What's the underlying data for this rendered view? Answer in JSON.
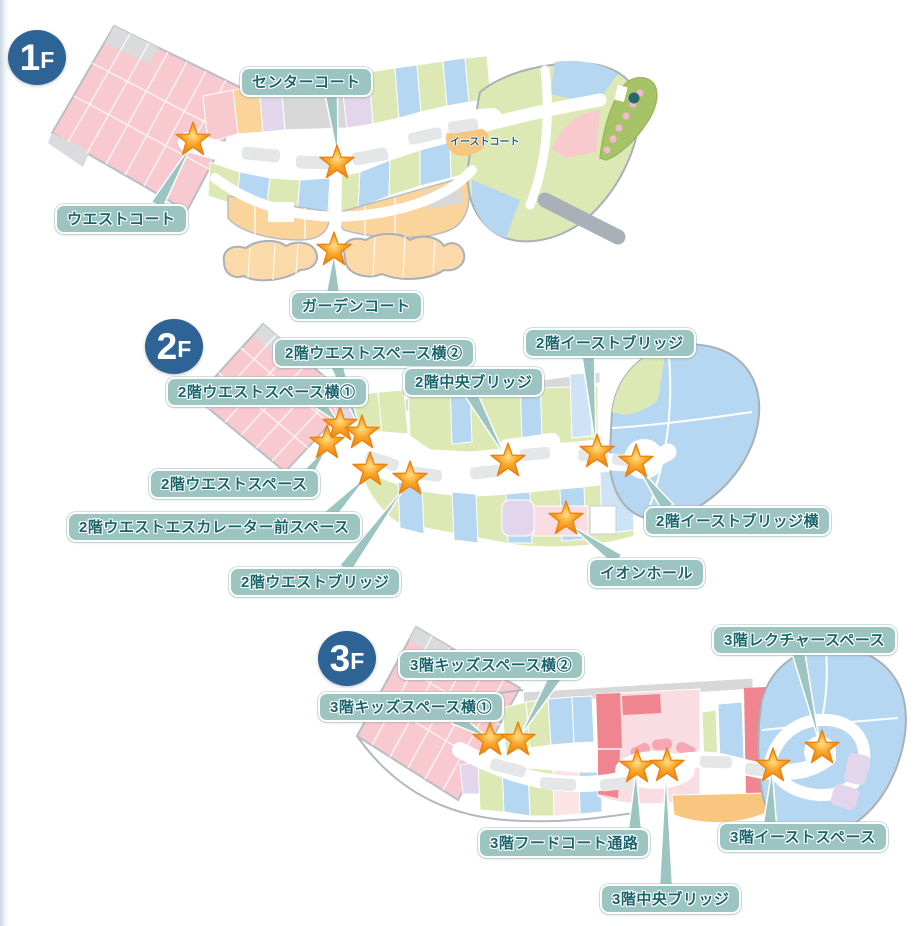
{
  "colors": {
    "badge_bg": "#2e6396",
    "badge_text": "#ffffff",
    "callout_bg": "#9cc5c1",
    "callout_text": "#19646c",
    "star_center": "#ffdf86",
    "star_mid": "#f9a62a",
    "star_outer": "#ef8008",
    "star_edge": "#e9820f",
    "map_pink": "#f8c9cf",
    "map_green": "#dce9b5",
    "map_blue": "#b5d7f2",
    "map_orange": "#fbd49c",
    "map_lavender": "#e2d5ec",
    "map_gray": "#d8d8d8",
    "map_food_pink": "#fadde2",
    "map_red": "#f0848f"
  },
  "floors": [
    {
      "id": "1f",
      "badge": {
        "number": "1",
        "suffix": "F",
        "cx": 37,
        "cy": 57
      },
      "stars": [
        [
          193,
          140
        ],
        [
          337,
          163
        ],
        [
          334,
          250
        ]
      ],
      "callouts": [
        {
          "text": "センターコート",
          "left": 240,
          "top": 67,
          "tail": {
            "from": [
              331,
              92
            ],
            "to": [
              338,
              158
            ]
          }
        },
        {
          "text": "ウエストコート",
          "left": 55,
          "top": 204,
          "tail": {
            "from": [
              157,
              205
            ],
            "to": [
              192,
              144
            ]
          }
        },
        {
          "text": "ガーデンコート",
          "left": 290,
          "top": 291,
          "tail": {
            "from": [
              333,
              292
            ],
            "to": [
              334,
              253
            ]
          }
        }
      ],
      "map_texts": [
        {
          "text": "イーストコート",
          "left": 450,
          "top": 133
        }
      ]
    },
    {
      "id": "2f",
      "badge": {
        "number": "2",
        "suffix": "F",
        "cx": 174,
        "cy": 346
      },
      "stars": [
        [
          340,
          425
        ],
        [
          362,
          433
        ],
        [
          327,
          443
        ],
        [
          370,
          470
        ],
        [
          410,
          479
        ],
        [
          508,
          461
        ],
        [
          597,
          452
        ],
        [
          636,
          462
        ],
        [
          566,
          519
        ]
      ],
      "callouts": [
        {
          "text": "2階ウエストスペース横②",
          "left": 273,
          "top": 338,
          "tail": {
            "from": [
              336,
              363
            ],
            "to": [
              360,
              430
            ]
          }
        },
        {
          "text": "2階ウエストスペース横①",
          "left": 166,
          "top": 377,
          "tail": {
            "from": [
              318,
              402
            ],
            "to": [
              339,
              423
            ]
          }
        },
        {
          "text": "2階中央ブリッジ",
          "left": 403,
          "top": 367,
          "tail": {
            "from": [
              470,
              392
            ],
            "to": [
              506,
              458
            ]
          }
        },
        {
          "text": "2階イーストブリッジ",
          "left": 524,
          "top": 328,
          "tail": {
            "from": [
              588,
              353
            ],
            "to": [
              596,
              449
            ]
          }
        },
        {
          "text": "2階ウエストスペース",
          "left": 149,
          "top": 469,
          "tail": {
            "from": [
              304,
              479
            ],
            "to": [
              328,
              446
            ]
          }
        },
        {
          "text": "2階ウエストエスカレーター前スペース",
          "left": 67,
          "top": 512,
          "tail": {
            "from": [
              328,
              517
            ],
            "to": [
              369,
              474
            ]
          }
        },
        {
          "text": "2階ウエストブリッジ",
          "left": 229,
          "top": 567,
          "tail": {
            "from": [
              345,
              569
            ],
            "to": [
              408,
              483
            ]
          }
        },
        {
          "text": "2階イーストブリッジ横",
          "left": 644,
          "top": 506,
          "tail": {
            "from": [
              668,
              508
            ],
            "to": [
              637,
              466
            ]
          }
        },
        {
          "text": "イオンホール",
          "left": 588,
          "top": 558,
          "tail": {
            "from": [
              618,
              560
            ],
            "to": [
              567,
              523
            ]
          }
        }
      ],
      "map_texts": []
    },
    {
      "id": "3f",
      "badge": {
        "number": "3",
        "suffix": "F",
        "cx": 347,
        "cy": 658
      },
      "stars": [
        [
          490,
          740
        ],
        [
          518,
          740
        ],
        [
          637,
          767
        ],
        [
          667,
          766
        ],
        [
          773,
          766
        ],
        [
          822,
          748
        ]
      ],
      "callouts": [
        {
          "text": "3階キッズスペース横②",
          "left": 398,
          "top": 650,
          "tail": {
            "from": [
              556,
              676
            ],
            "to": [
              519,
              738
            ]
          }
        },
        {
          "text": "3階キッズスペース横①",
          "left": 318,
          "top": 692,
          "tail": {
            "from": [
              455,
              718
            ],
            "to": [
              488,
              738
            ]
          }
        },
        {
          "text": "3階レクチャースペース",
          "left": 712,
          "top": 625,
          "tail": {
            "from": [
              798,
              651
            ],
            "to": [
              820,
              745
            ]
          }
        },
        {
          "text": "3階フードコート通路",
          "left": 478,
          "top": 828,
          "tail": {
            "from": [
              635,
              829
            ],
            "to": [
              636,
              770
            ]
          }
        },
        {
          "text": "3階中央ブリッジ",
          "left": 600,
          "top": 884,
          "tail": {
            "from": [
              666,
              885
            ],
            "to": [
              666,
              769
            ]
          }
        },
        {
          "text": "3階イーストスペース",
          "left": 718,
          "top": 822,
          "tail": {
            "from": [
              770,
              823
            ],
            "to": [
              772,
              769
            ]
          }
        }
      ],
      "map_texts": []
    }
  ]
}
